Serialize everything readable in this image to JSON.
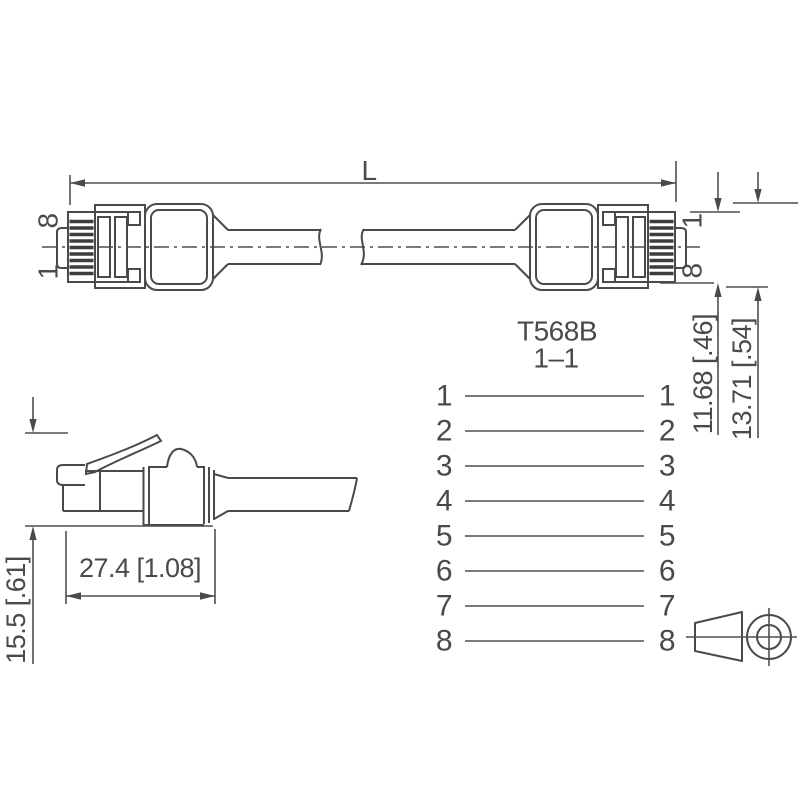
{
  "drawing": {
    "title": "RJ45 patch cable dimensional drawing",
    "length_dim_label": "L",
    "connector_left": {
      "pin_top": "8",
      "pin_bottom": "1"
    },
    "connector_right": {
      "pin_top": "1",
      "pin_bottom": "8"
    },
    "width_dims": {
      "plug_width": "11.68 [.46]",
      "body_width": "13.71 [.54]"
    },
    "wiring": {
      "standard": "T568B",
      "scheme": "1–1",
      "left_pins": [
        "1",
        "2",
        "3",
        "4",
        "5",
        "6",
        "7",
        "8"
      ],
      "right_pins": [
        "1",
        "2",
        "3",
        "4",
        "5",
        "6",
        "7",
        "8"
      ]
    },
    "side_view": {
      "length": "27.4 [1.08]",
      "height": "15.5 [.61]"
    },
    "colors": {
      "line": "#4a4a4a",
      "background": "#ffffff"
    }
  }
}
